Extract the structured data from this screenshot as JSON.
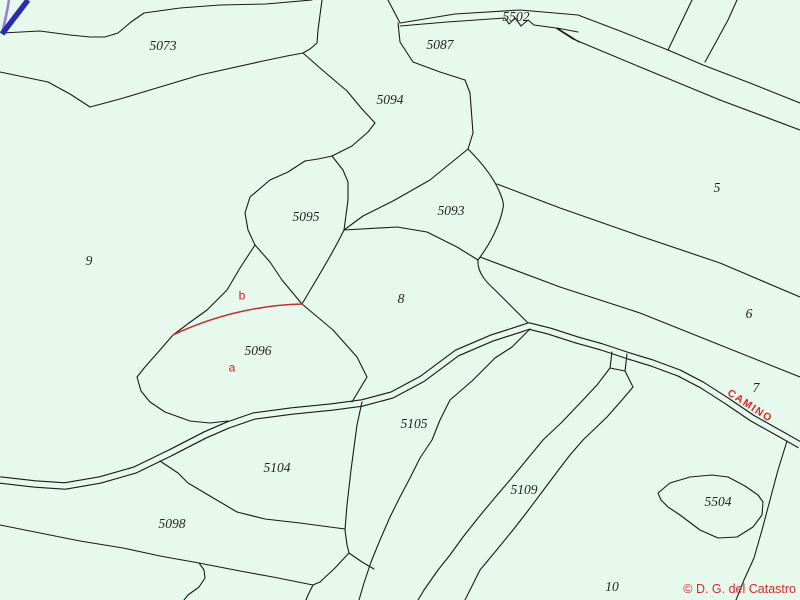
{
  "map": {
    "road_label": "CAMINO",
    "attribution": "© D. G. del Catastro"
  },
  "colors": {
    "background": "#e7f8ec",
    "boundary": "#1b1b1b",
    "subparcel_line": "#c13237",
    "subparcel_label": "#cc2222",
    "road_label_color": "#d42a2a",
    "attribution_color": "#d62b2b",
    "parcel_label_color": "#222222",
    "decor_blue": "#2b2bb2",
    "decor_purple": "#9d7fd2"
  },
  "parcels": [
    {
      "id": "5073",
      "x": 163,
      "y": 47,
      "type": "parcel"
    },
    {
      "id": "5502",
      "x": 516,
      "y": 18,
      "type": "parcel"
    },
    {
      "id": "5087",
      "x": 440,
      "y": 46,
      "type": "parcel"
    },
    {
      "id": "5094",
      "x": 390,
      "y": 101,
      "type": "parcel"
    },
    {
      "id": "5095",
      "x": 306,
      "y": 218,
      "type": "parcel"
    },
    {
      "id": "5093",
      "x": 451,
      "y": 212,
      "type": "parcel"
    },
    {
      "id": "9",
      "x": 89,
      "y": 262,
      "type": "parcel"
    },
    {
      "id": "8",
      "x": 401,
      "y": 300,
      "type": "parcel"
    },
    {
      "id": "5",
      "x": 717,
      "y": 189,
      "type": "parcel"
    },
    {
      "id": "6",
      "x": 749,
      "y": 315,
      "type": "parcel"
    },
    {
      "id": "7",
      "x": 756,
      "y": 389,
      "type": "parcel"
    },
    {
      "id": "b",
      "x": 242,
      "y": 296,
      "type": "subparcel"
    },
    {
      "id": "5096",
      "x": 258,
      "y": 352,
      "type": "parcel"
    },
    {
      "id": "a",
      "x": 232,
      "y": 368,
      "type": "subparcel"
    },
    {
      "id": "5105",
      "x": 414,
      "y": 425,
      "type": "parcel"
    },
    {
      "id": "5104",
      "x": 277,
      "y": 469,
      "type": "parcel"
    },
    {
      "id": "5109",
      "x": 524,
      "y": 491,
      "type": "parcel"
    },
    {
      "id": "5098",
      "x": 172,
      "y": 525,
      "type": "parcel"
    },
    {
      "id": "5504",
      "x": 718,
      "y": 503,
      "type": "parcel"
    },
    {
      "id": "10",
      "x": 612,
      "y": 588,
      "type": "parcel"
    }
  ]
}
